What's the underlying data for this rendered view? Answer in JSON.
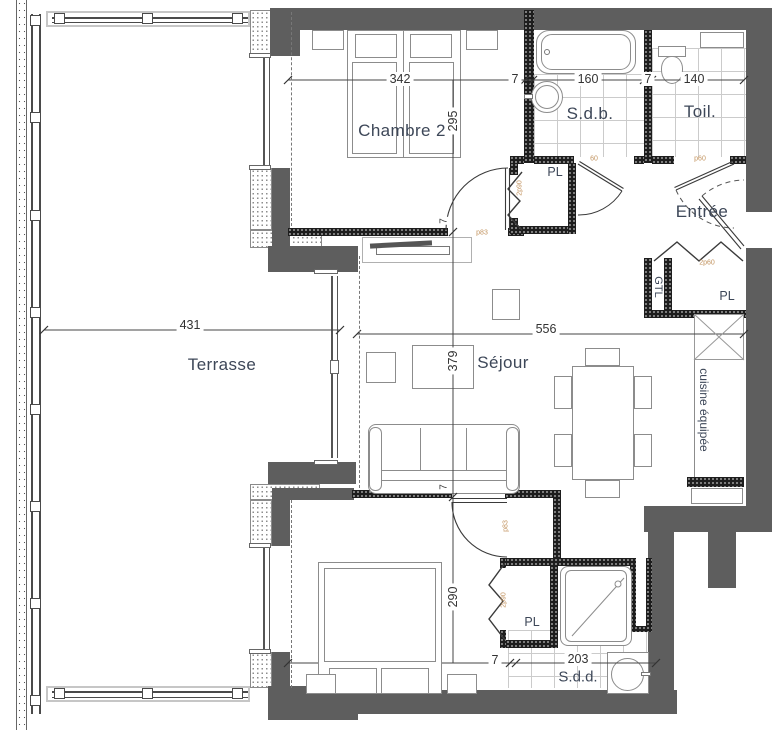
{
  "title": "Apartment floor plan",
  "rooms": {
    "chambre2": "Chambre 2",
    "sdb": "S.d.b.",
    "toil": "Toil.",
    "entree": "Entrée",
    "terrasse": "Terrasse",
    "sejour": "Séjour",
    "chambre1": "Chambre 1",
    "sdd": "S.d.d.",
    "cuisine": "cuisine équipée",
    "gtl": "GTL"
  },
  "closets": {
    "pl_entree": "PL",
    "pl_kitchen": "PL",
    "pl_chambre1": "PL"
  },
  "dimensions": {
    "chambre2_width": "342",
    "wall_top_a": "7",
    "sdb_width": "160",
    "wall_top_b": "7",
    "toil_width": "140",
    "chambre2_depth": "295",
    "terrasse_width": "431",
    "sejour_width": "556",
    "sejour_depth": "379",
    "chambre1_depth": "290",
    "chambre1_width": "319",
    "wall_bottom": "7",
    "sdd_width": "203",
    "door_jamb_top": "7",
    "door_jamb_bottom": "7"
  },
  "door_tags": {
    "chambre2_door": "p83",
    "chambre1_door": "p83",
    "closet_chambre2": "2p90",
    "closet_chambre1": "2p90",
    "closet_gtl": "2p60",
    "sdb_door": "60",
    "toil_door": "p60"
  },
  "colors": {
    "exterior_wall": "#5e5e5e",
    "interior_wall": "#1d1d1d",
    "label_text": "#3d4758",
    "dimension_text": "#333333",
    "door_tag": "#c2935f"
  }
}
